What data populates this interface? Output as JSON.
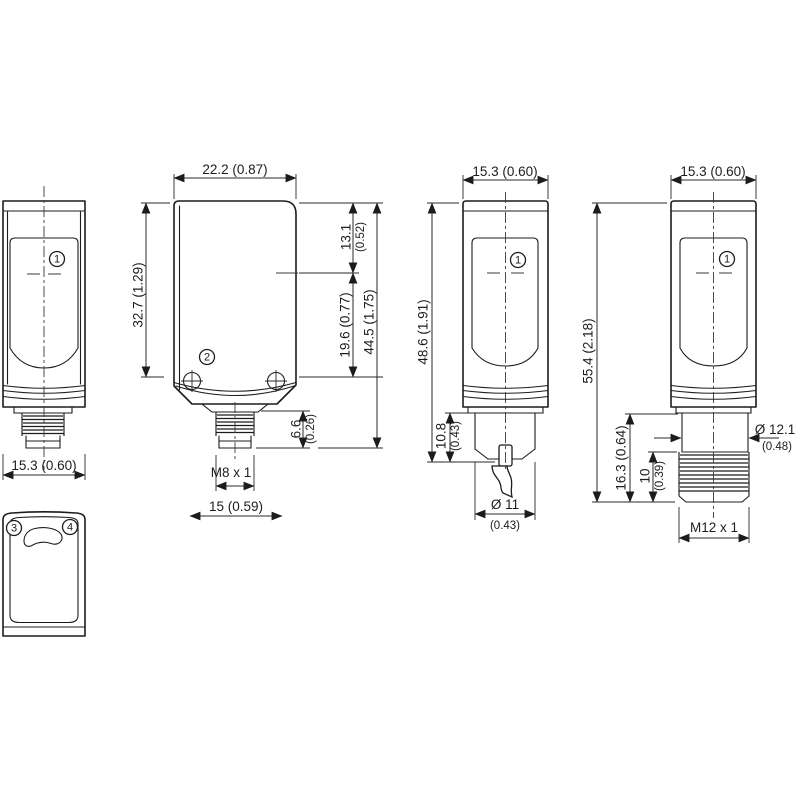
{
  "drawing": {
    "type": "sensor-dimensional-drawing",
    "colors": {
      "line": "#1c1c1c",
      "background": "#ffffff"
    }
  },
  "side_view": {
    "width_dim": "15.3 (0.60)",
    "marker": "1"
  },
  "face_view": {
    "marker_left": "3",
    "marker_right": "4"
  },
  "front_view": {
    "width_dim": "22.2 (0.87)",
    "body_height_dim": "32.7 (1.29)",
    "axis_offset_dim": "13.1",
    "axis_offset_in": "(0.52)",
    "hole_offset_dim": "19.6 (0.77)",
    "total_height_dim": "44.5 (1.75)",
    "connector_height_dim": "6.6",
    "connector_height_in": "(0.26)",
    "thread_label": "M8 x 1",
    "flange_width_dim": "15 (0.59)",
    "marker": "2"
  },
  "cable_view": {
    "width_dim": "15.3 (0.60)",
    "height_dim": "48.6 (1.91)",
    "gland_height_dim": "10.8",
    "gland_height_in": "(0.43)",
    "cable_dia_dim": "Ø 11",
    "cable_dia_in": "(0.43)",
    "marker": "1"
  },
  "m12_view": {
    "width_dim": "15.3 (0.60)",
    "total_height_dim": "55.4 (2.18)",
    "connector_height_dim": "16.3 (0.64)",
    "thread_length_dim": "10",
    "thread_length_in": "(0.39)",
    "dia_dim": "Ø 12.1",
    "dia_in": "(0.48)",
    "thread_label": "M12 x 1",
    "marker": "1"
  }
}
